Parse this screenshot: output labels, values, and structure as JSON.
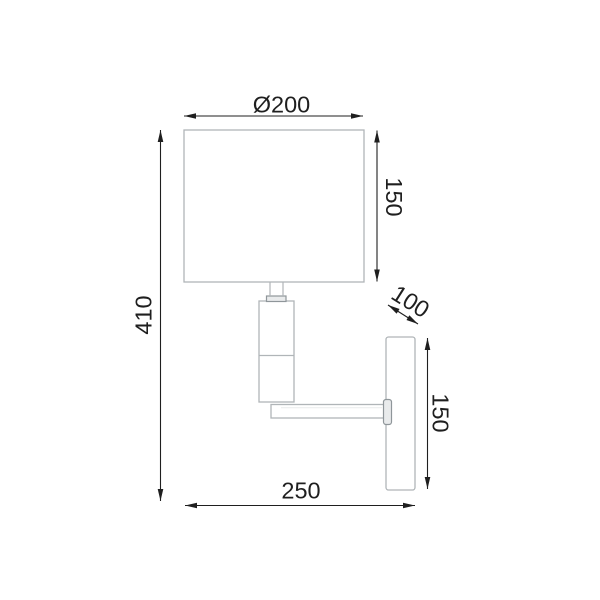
{
  "drawing": {
    "description": "wall lamp side-view technical drawing with dimensions",
    "dimensions": {
      "shade_diameter": {
        "label": "Ø200"
      },
      "shade_height": {
        "label": "150"
      },
      "total_height": {
        "label": "410"
      },
      "plate_depth": {
        "label": "100"
      },
      "plate_height": {
        "label": "150"
      },
      "overall_width": {
        "label": "250"
      }
    },
    "colors": {
      "dimension": "#1f1f1f",
      "outline": "#b0b5b8",
      "outline-dark": "#8f969a",
      "fill-light": "#e9ebec",
      "background": "#ffffff"
    }
  }
}
